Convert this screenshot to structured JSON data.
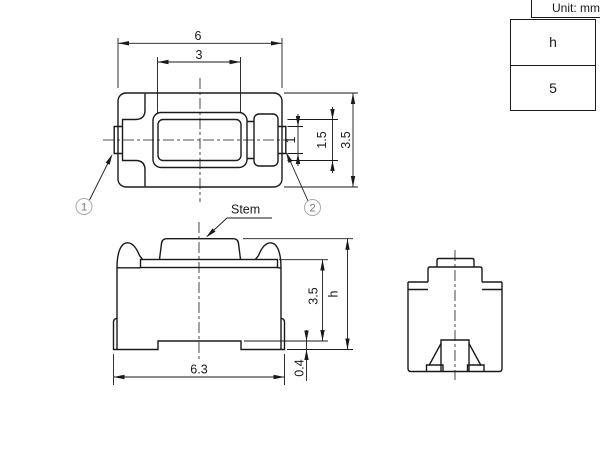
{
  "meta": {
    "unit_label": "Unit: mm"
  },
  "spec_table": {
    "parameter": "h",
    "value": "5"
  },
  "labels": {
    "stem": "Stem",
    "callout_1": "1",
    "callout_2": "2"
  },
  "dimensions": {
    "top_view": {
      "body_width": "6",
      "stem_width": "3",
      "terminal_width": "1",
      "contact_width": "1.5",
      "body_depth": "3.5"
    },
    "front_view": {
      "terminal_span": "6.3",
      "standoff_height": "0.4",
      "body_height": "3.5",
      "overall_height": "h"
    }
  }
}
